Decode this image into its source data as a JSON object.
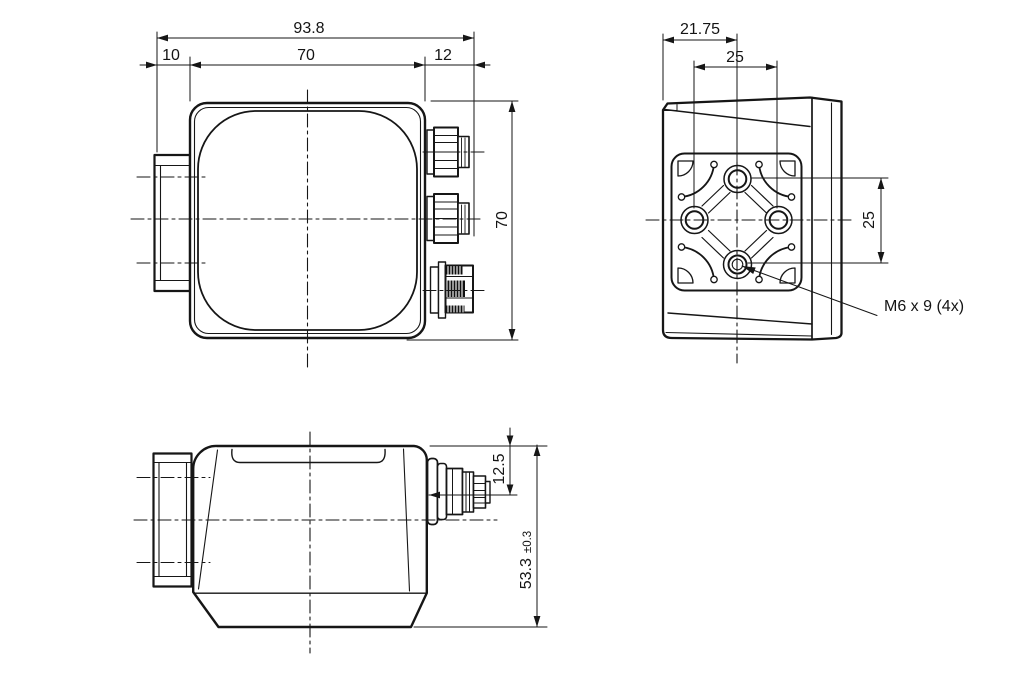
{
  "drawing": {
    "front": {
      "overall_width": "93.8",
      "mount_block_depth": "10",
      "body_width": "70",
      "connector_clearance": "12",
      "body_height": "70"
    },
    "side": {
      "edge_to_hole": "21.75",
      "hole_spacing_horizontal": "25",
      "hole_spacing_vertical": "25",
      "mounting_holes": "M6 x 9 (4x)"
    },
    "bottom": {
      "connector_axis_offset": "12.5",
      "overall_depth": "53.3",
      "depth_tolerance": "±0.3"
    }
  }
}
